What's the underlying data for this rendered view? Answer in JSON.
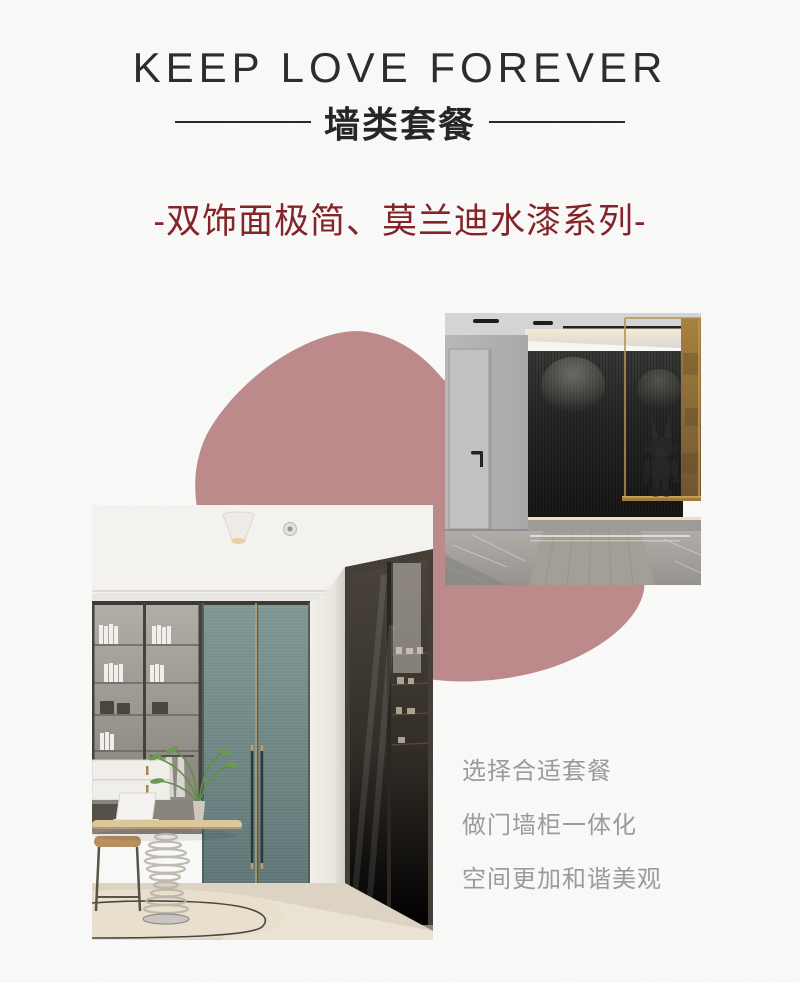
{
  "header": {
    "title": "KEEP LOVE FOREVER",
    "subtitle": "墙类套餐",
    "series_line": "-双饰面极简、莫兰迪水漆系列-"
  },
  "features": {
    "lines": [
      "选择合适套餐",
      "做门墙柜一体化",
      "空间更加和谐美观"
    ]
  },
  "colors": {
    "accent_maroon": "#832428",
    "blob_rose": "#bd8a8b",
    "title_ink": "#2d2d2d",
    "feature_gray": "#9b9b9b",
    "paper": "#fbfbfa"
  }
}
